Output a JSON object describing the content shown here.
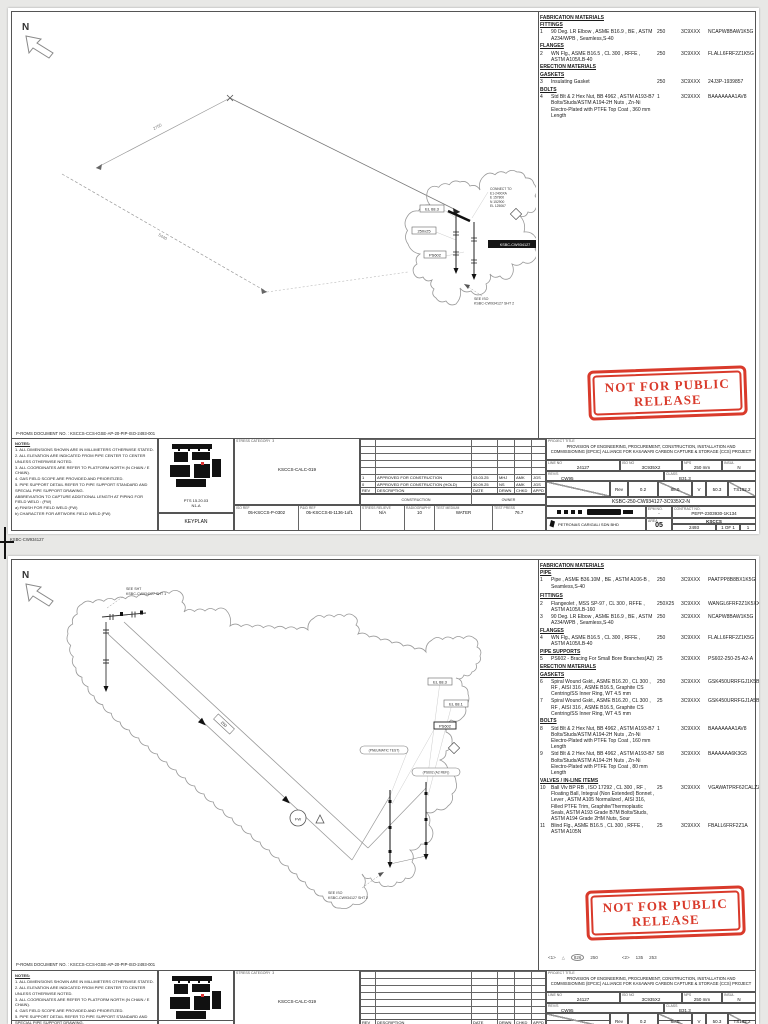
{
  "stamp": {
    "line1": "NOT FOR PUBLIC",
    "line2": "RELEASE",
    "color": "#d93a2b"
  },
  "between": {
    "file_no": "KSBC-CW934127"
  },
  "doc_no": "P-ROMS DOCUMENT NO. :  KSCCS-CCS-IGSE-AP-20-PIP-ISO-2493-001",
  "north": "N",
  "notes_title": "NOTES:",
  "notes": [
    "1. ALL DIMENSIONS SHOWN ARE IN MILLIMETERS OTHERWISE STATED.",
    "2. ALL ELEVATION ARE INDICATED FROM PIPE CENTER TO CENTER UNLESS OTHERWISE NOTED.",
    "3. ALL COORDINATES ARE REFER TO PLATFORM NORTH (N CHAIN / E CHAIN).",
    "4. GAS FIELD SCOPE ARE PROVIDED AND PRIORITIZED.",
    "5. PIPE SUPPORT DETAIL REFER TO PIPE SUPPORT STANDARD AND SPECIAL PIPE SUPPORT DRAWING.",
    "ABBREVIATION TO CAPTURE ADDITIONAL LENGTH AT PIPING FOR FIELD WELD : (FW)",
    "a) FINISH FOR FIELD WELD (FW)",
    "b) CHARACTER FOR ARTWORK FIELD WELD (FW)"
  ],
  "keyplan": {
    "pts": "PTS 15.20.03",
    "grid": "N1-A",
    "caption": "KEYPLAN"
  },
  "stress": {
    "label": "STRESS CATEGORY",
    "value": "3",
    "calc_ref": "KSCCS-CALC-019"
  },
  "rt": {
    "h": [
      "REV",
      "DESCRIPTION",
      "DATE",
      "DRWN",
      "CHKD",
      "APPD"
    ],
    "sub_left": "CONSTRUCTION",
    "sub_right": "OWNER"
  },
  "refrow": [
    {
      "l": "ISO REF",
      "v": "05-KSCCS-P-0302"
    },
    {
      "l": "P&ID REF",
      "v": "05-KSCCS-B-1136-1of1"
    },
    {
      "l": "STRESS RELIEVE",
      "v": "N/A"
    },
    {
      "l": "RADIOGRAPHY",
      "v": "10"
    },
    {
      "l": "TEST MEDIUM",
      "v": "WATER"
    },
    {
      "l": "TEST PRESS",
      "v": "76.7"
    }
  ],
  "tb": {
    "project_label": "PROJECT TITLE",
    "title1": "PROVISION OF ENGINEERING, PROCUREMENT, CONSTRUCTION, INSTALLATION AND",
    "title2": "COMMISSIONING (EPCIC) ALLIANCE FOR KASAWARI CARBON CAPTURE & STORAGE (CCS) PROJECT",
    "line_lbl": "LINE NO",
    "line": "24127",
    "iso_lbl": "ISO NO",
    "iso": "3C935X2",
    "nps_lbl": "NPS",
    "nps": "250 mm",
    "ins_lbl": "INSUL",
    "ins": "N",
    "srv_lbl": "REV/S",
    "srv": "CW95",
    "cls_lbl": "CLASS",
    "cls": "B31.3",
    "sr_rev_lbl": "Rev",
    "sr_rev": "0.2",
    "sr_a": "88.0",
    "sr_b": "V",
    "sr_c": "50.3",
    "sr_d": "TS102.2",
    "dwg": "KSBC-250-CW934127-3C935X2-N",
    "epm_lbl": "EPM NO.",
    "epm": "-",
    "con_lbl": "CONTRACT NO.",
    "con": "PEFP-2303930-1K134",
    "company": "PETRONAS CARIGALI SDN BHD",
    "area_lbl": "AREA",
    "area": "05",
    "field": "KSCCS",
    "dno_lbl": "DRAWING NO.",
    "dno": "2493",
    "sht_lbl": "SHT NO.",
    "sht": "1 OF 1",
    "rev_lbl": "REV NO.",
    "rev": "1"
  },
  "page1": {
    "materials": {
      "rows": [
        {
          "hh": 1,
          "x": "FABRICATION MATERIALS"
        },
        {
          "hh": 1,
          "x": "FITTINGS"
        },
        {
          "rr": 1,
          "ncl": 1,
          "n": "1",
          "d": "90 Deg. LR Elbow , ASME B16.9 , BE , ASTM A234/WPB , Seamless,S-40",
          "s": "250",
          "c": "3C9XXX",
          "m": "NCAPW8BAW1K5G",
          "q": "1"
        },
        {
          "hh": 1,
          "x": "FLANGES"
        },
        {
          "rr": 1,
          "ncl": 1,
          "n": "2",
          "d": "WN Flg., ASME B16.5 , CL 300 , RFFE , ASTM A105/LB-40",
          "s": "250",
          "c": "3C9XXX",
          "m": "FLALL6FRF2Z1K5G",
          "q": "2"
        },
        {
          "hh": 1,
          "x": "ERECTION MATERIALS"
        },
        {
          "hh": 1,
          "x": "GASKETS"
        },
        {
          "rr": 1,
          "ncl": 1,
          "n": "3",
          "d": "Insulating Gasket",
          "s": "250",
          "c": "3C9XXX",
          "m": "24J3P-1939857",
          "q": "1"
        },
        {
          "hh": 1,
          "x": "BOLTS"
        },
        {
          "rr": 1,
          "ncl": 1,
          "n": "4",
          "d": "Std Blt & 2 Hex Nut, BB 4962 , ASTM A193-B7 Bolts/Studs/ASTM A194-2H Nuts , Zn-Ni Electro-Plated with PTFE Top Coat , 360 mm Length",
          "s": "1",
          "c": "3C9XXX",
          "m": "BAAAAAAA1AV8",
          "q": "16"
        }
      ]
    },
    "rev_rows": [
      {
        "rev": "",
        "desc": "",
        "date": "",
        "a": "",
        "b": "",
        "c": ""
      },
      {
        "rev": "",
        "desc": "",
        "date": "",
        "a": "",
        "b": "",
        "c": ""
      },
      {
        "rev": "",
        "desc": "",
        "date": "",
        "a": "",
        "b": "",
        "c": ""
      },
      {
        "rev": "",
        "desc": "",
        "date": "",
        "a": "",
        "b": "",
        "c": ""
      },
      {
        "rev": "",
        "desc": "",
        "date": "",
        "a": "",
        "b": "",
        "c": ""
      },
      {
        "rev": "1",
        "desc": "APPROVED FOR CONSTRUCTION",
        "date": "03.03.25",
        "a": "MHJ",
        "b": "AMK",
        "c": "JGS"
      },
      {
        "rev": "0",
        "desc": "APPROVED FOR CONSTRUCTION (HOLD)",
        "date": "30.09.25",
        "a": "NS",
        "b": "AMK",
        "c": "JGS"
      }
    ],
    "drawing": {
      "dim1": "2750",
      "dim2": "5440",
      "lbl_el": "EL 68.3",
      "lbl_sz": "250x25",
      "lbl_ps": "PS602",
      "match": "KSBC-CW934127",
      "connect": [
        "CONNECT TO",
        "E1-2400XA",
        "E 157800",
        "N 152900",
        "EL 125067"
      ],
      "see1": "SEE ISO",
      "see2": "KSBC-CW934127 SHT 2"
    }
  },
  "page2": {
    "materials": {
      "rows": [
        {
          "hh": 1,
          "x": "FABRICATION MATERIALS"
        },
        {
          "hh": 1,
          "x": "PIPE"
        },
        {
          "rr": 1,
          "cl": 1,
          "n": "1",
          "d": "Pipe , ASME B36.10M , BE , ASTM A106-B , Seamless,S-40",
          "s": "250",
          "c": "3C9XXX",
          "m": "PAATPP8B8BX1K5G",
          "q": "0.987 M"
        },
        {
          "hh": 1,
          "x": "FITTINGS"
        },
        {
          "rr": 1,
          "ncl": 1,
          "n": "2",
          "d": "Flangeolet , MSS SP-97 , CL 300 , RFFE , ASTM A105/LB-160",
          "s": "250X25",
          "c": "3C9XXX",
          "m": "WANGL6FRF2Z1K5XXG",
          "q": "1"
        },
        {
          "rr": 1,
          "ncl": 1,
          "n": "3",
          "d": "90 Deg. LR Elbow , ASME B16.9 , BE , ASTM A234/WPB , Seamless,S-40",
          "s": "250",
          "c": "3C9XXX",
          "m": "NCAPW8BAW1K5G",
          "q": "1"
        },
        {
          "hh": 1,
          "x": "FLANGES"
        },
        {
          "rr": 1,
          "ncl": 1,
          "n": "4",
          "d": "WN Flg., ASME B16.5 , CL 300 , RFFE , ASTM A105/LB-40",
          "s": "250",
          "c": "3C9XXX",
          "m": "FLALL6FRF2Z1K5G",
          "q": "1"
        },
        {
          "hh": 1,
          "x": "PIPE SUPPORTS"
        },
        {
          "rr": 1,
          "ncl": 1,
          "n": "5",
          "d": "PS602 - Bracing For Small Bore Branches(A2)",
          "s": "25",
          "c": "3C9XXX",
          "m": "PS602-250-25-A2-A",
          "q": "1"
        },
        {
          "hh": 1,
          "x": "ERECTION MATERIALS"
        },
        {
          "hh": 1,
          "x": "GASKETS"
        },
        {
          "rr": 1,
          "ncl": 1,
          "n": "6",
          "d": "Spiral Wound Gskt., ASME B16.20 , CL 300 , RF , AISI 316 , ASME B16.5, Graphite CS Centring/SS Inner Ring, WT 4.5 mm",
          "s": "250",
          "c": "3C9XXX",
          "m": "GSK450URRFGJ1K5B",
          "q": "1"
        },
        {
          "rr": 1,
          "ncl": 1,
          "n": "7",
          "d": "Spiral Wound Gskt., ASME B16.20 , CL 300 , RF , AISI 316 , ASME B16.5, Graphite CS Centring/SS Inner Ring, WT 4.5 mm",
          "s": "25",
          "c": "3C9XXX",
          "m": "GSK450URRFGJ1A5B",
          "q": "2"
        },
        {
          "hh": 1,
          "x": "BOLTS"
        },
        {
          "rr": 1,
          "ncl": 1,
          "n": "8",
          "d": "Std Blt & 2 Hex Nut, BB 4962 , ASTM A193-B7 Bolts/Studs/ASTM A194-2H Nuts , Zn-Ni Electro-Plated with PTFE Top Coat , 160 mm Length",
          "s": "1",
          "c": "3C9XXX",
          "m": "BAAAAAAA1AV8",
          "q": "16"
        },
        {
          "rr": 1,
          "ncl": 1,
          "n": "9",
          "d": "Std Blt & 2 Hex Nut, BB 4962 , ASTM A193-B7 Bolts/Studs/ASTM A194-2H Nuts , Zn-Ni Electro-Plated with PTFE Top Coat , 80 mm Length",
          "s": "5/8",
          "c": "3C9XXX",
          "m": "BAAAAAA6K3G5",
          "q": "8"
        },
        {
          "hh": 1,
          "x": "VALVES / IN-LINE ITEMS"
        },
        {
          "rr": 1,
          "ncl": 1,
          "n": "10",
          "d": "Ball Vlv BP RB , ISO 17292 , CL 300 , RF , Floating Ball, Integral (Non Extended) Bonnet , Lever , ASTM A105 Normalized , AISI 316, Filled PTFE Trim, Graphite/Thermoplastic Seals, ASTM A193 Grade B7M Bolts/Studs, ASTM A194 Grade 2HM Nuts, Sour",
          "s": "25",
          "c": "3C9XXX",
          "m": "VGAWATPRF62CALZZ1A",
          "q": "1"
        },
        {
          "rr": 1,
          "ncl": 1,
          "n": "11",
          "d": "Blind Flg., ASME B16.5 , CL 300 , RFFE , ASTM A105N",
          "s": "25",
          "c": "3C9XXX",
          "m": "FBALL6FRF2Z1A",
          "q": "1"
        }
      ]
    },
    "rev_rows": [
      {
        "rev": "",
        "desc": "",
        "date": "",
        "a": "",
        "b": "",
        "c": ""
      },
      {
        "rev": "",
        "desc": "",
        "date": "",
        "a": "",
        "b": "",
        "c": ""
      },
      {
        "rev": "",
        "desc": "",
        "date": "",
        "a": "",
        "b": "",
        "c": ""
      },
      {
        "rev": "",
        "desc": "",
        "date": "",
        "a": "",
        "b": "",
        "c": ""
      },
      {
        "rev": "",
        "desc": "",
        "date": "",
        "a": "",
        "b": "",
        "c": ""
      },
      {
        "rev": "",
        "desc": "",
        "date": "",
        "a": "",
        "b": "",
        "c": ""
      },
      {
        "rev": "",
        "desc": "",
        "date": "",
        "a": "",
        "b": "",
        "c": ""
      }
    ],
    "drawing": {
      "see_a1": "SEE SHT",
      "see_a2": "KSBC-CW934127 SHT 1",
      "run_lbl": "250",
      "lbl_el1": "EL 68.3",
      "lbl_el2": "EL 68.1",
      "lbl_ps": "PS602",
      "oval1": "(PNEUMATIC TEST)",
      "oval2": "(PS602 (A2 REF))",
      "fw": "FW",
      "see_b1": "SEE ISO",
      "see_b2": "KSBC-CW934127 SHT 2"
    },
    "cont": [
      "<1>",
      "826",
      "250",
      "<2>",
      "135",
      "253"
    ]
  }
}
